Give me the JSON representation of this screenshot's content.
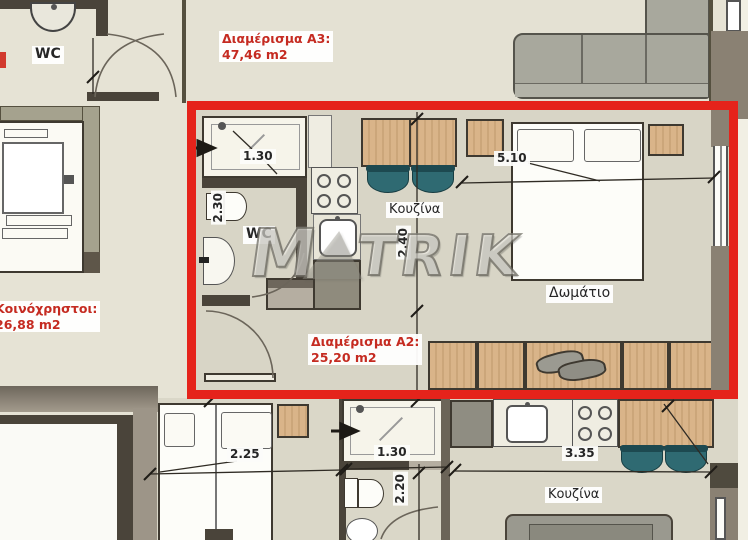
{
  "plan": {
    "watermark": {
      "left": "M",
      "right": "TRIK",
      "full": "MATRIK"
    },
    "apartments": {
      "a3": {
        "title": "Διαμέρισμα A3:",
        "area": "47,46 m2"
      },
      "a2": {
        "title": "Διαμέρισμα A2:",
        "area": "25,20 m2"
      },
      "common": {
        "title": "Κοινόχρηστοι:",
        "area": "26,88 m2"
      }
    },
    "rooms": {
      "wc_top_left": "WC",
      "wc_a2": "WC",
      "kitchen_a2": "Κουζίνα",
      "bedroom_a2": "Δωμάτιο",
      "kitchen_bottom": "Κουζίνα"
    },
    "dimensions": {
      "a2_shower_width": "1.30",
      "a2_wc_width": "2.30",
      "a2_bedroom_width": "5.10",
      "a2_kitchen_depth": "2.40",
      "bottom_bed_width": "2.25",
      "bottom_shower_width": "1.30",
      "bottom_wc_depth": "2.20",
      "bottom_kitchen_width": "3.35"
    },
    "colors": {
      "highlight_box": "#e5231b",
      "red_label_text": "#c52b21",
      "wood": "#d9b489",
      "chair_teal": "#2f6a72",
      "wall_dark": "#4a443a",
      "floor": "#d8d5c6"
    },
    "fixtures": [
      "elevator",
      "double-door",
      "shower",
      "toilet",
      "wash-basin",
      "washing-machine",
      "stove",
      "kitchen-sink",
      "dining-table",
      "chair",
      "double-bed",
      "single-bed",
      "nightstand",
      "wardrobe",
      "sofa",
      "couch",
      "window",
      "door-arc",
      "pillow"
    ]
  }
}
